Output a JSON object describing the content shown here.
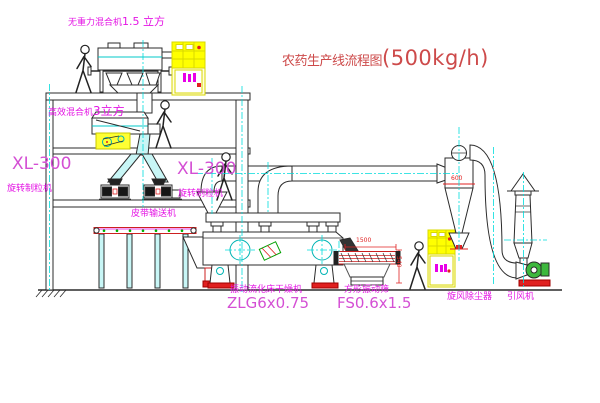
{
  "title": {
    "name": "农药生产线流程图",
    "capacity": "(500kg/h)"
  },
  "equipment": {
    "top_mixer": {
      "name": "无重力混合机",
      "size": "1.5 立方"
    },
    "mezz_mixer": {
      "name": "高效混合机",
      "size": "3立方"
    },
    "granulator_left": {
      "model": "XL-300",
      "name": "旋转制粒机"
    },
    "granulator_right": {
      "model": "XL-300",
      "name": "旋转制粒机"
    },
    "belt_conveyor": {
      "name": "皮带输送机"
    },
    "fluid_bed_dryer": {
      "name": "振动流化床干燥机",
      "model": "ZLG6x0.75"
    },
    "vibrating_screen": {
      "name": "方形振动筛",
      "model": "FS0.6x1.5",
      "length_dim": "1500",
      "height_dim": "540"
    },
    "cyclone": {
      "name": "旋风除尘器",
      "dim": "600"
    },
    "fan": {
      "name": "引风机"
    }
  },
  "colors": {
    "label_magenta": "#e414e4",
    "model_magenta": "#d44fd4",
    "title_red": "#cd4a4a",
    "dimension_red": "#e02020",
    "line_dark": "#2b2b2b",
    "centerline_cyan": "#00dcdc",
    "cabinet_yellow": "#ffff00",
    "fan_green": "#3db83d"
  }
}
